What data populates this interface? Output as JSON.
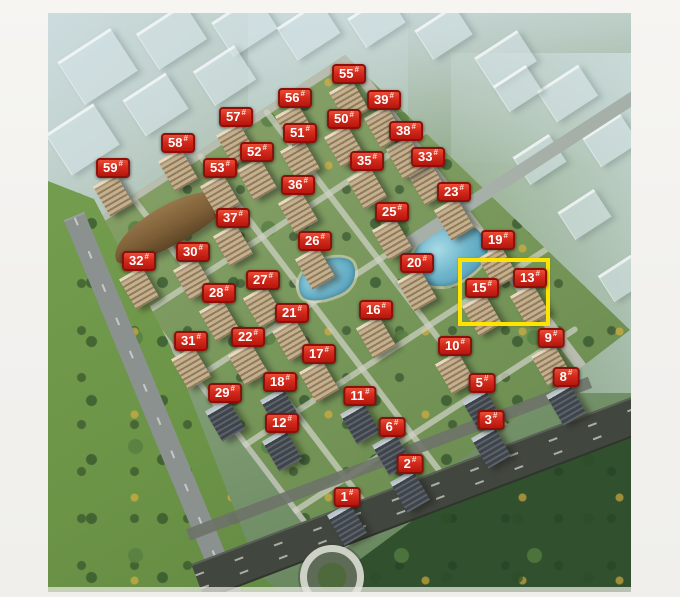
{
  "badge_suffix": "#",
  "buildings": [
    {
      "label": "1",
      "x": 347,
      "y": 497
    },
    {
      "label": "2",
      "x": 410,
      "y": 464
    },
    {
      "label": "3",
      "x": 491,
      "y": 420
    },
    {
      "label": "5",
      "x": 482,
      "y": 383
    },
    {
      "label": "6",
      "x": 392,
      "y": 427
    },
    {
      "label": "8",
      "x": 566,
      "y": 377
    },
    {
      "label": "9",
      "x": 551,
      "y": 338
    },
    {
      "label": "10",
      "x": 455,
      "y": 346
    },
    {
      "label": "11",
      "x": 360,
      "y": 396
    },
    {
      "label": "12",
      "x": 282,
      "y": 423
    },
    {
      "label": "13",
      "x": 530,
      "y": 278
    },
    {
      "label": "15",
      "x": 482,
      "y": 288
    },
    {
      "label": "16",
      "x": 376,
      "y": 310
    },
    {
      "label": "17",
      "x": 319,
      "y": 354
    },
    {
      "label": "18",
      "x": 280,
      "y": 382
    },
    {
      "label": "19",
      "x": 498,
      "y": 240
    },
    {
      "label": "20",
      "x": 417,
      "y": 263
    },
    {
      "label": "21",
      "x": 292,
      "y": 313
    },
    {
      "label": "22",
      "x": 248,
      "y": 337
    },
    {
      "label": "23",
      "x": 454,
      "y": 192
    },
    {
      "label": "25",
      "x": 392,
      "y": 212
    },
    {
      "label": "26",
      "x": 315,
      "y": 241
    },
    {
      "label": "27",
      "x": 263,
      "y": 280
    },
    {
      "label": "28",
      "x": 219,
      "y": 293
    },
    {
      "label": "29",
      "x": 225,
      "y": 393
    },
    {
      "label": "30",
      "x": 193,
      "y": 252
    },
    {
      "label": "31",
      "x": 191,
      "y": 341
    },
    {
      "label": "32",
      "x": 139,
      "y": 261
    },
    {
      "label": "33",
      "x": 428,
      "y": 157
    },
    {
      "label": "35",
      "x": 367,
      "y": 161
    },
    {
      "label": "36",
      "x": 298,
      "y": 185
    },
    {
      "label": "37",
      "x": 233,
      "y": 218
    },
    {
      "label": "38",
      "x": 406,
      "y": 131
    },
    {
      "label": "39",
      "x": 384,
      "y": 100
    },
    {
      "label": "50",
      "x": 344,
      "y": 119
    },
    {
      "label": "51",
      "x": 300,
      "y": 133
    },
    {
      "label": "52",
      "x": 257,
      "y": 152
    },
    {
      "label": "53",
      "x": 220,
      "y": 168
    },
    {
      "label": "55",
      "x": 349,
      "y": 74
    },
    {
      "label": "56",
      "x": 295,
      "y": 98
    },
    {
      "label": "57",
      "x": 236,
      "y": 117
    },
    {
      "label": "58",
      "x": 178,
      "y": 143
    },
    {
      "label": "59",
      "x": 113,
      "y": 168
    }
  ],
  "highlight": {
    "x": 458,
    "y": 258,
    "width": 92,
    "height": 68,
    "color": "#ffe400",
    "contains": [
      "15#",
      "13#"
    ]
  },
  "colors": {
    "badge_fill": "#d42a1c",
    "badge_border": "#8c0f09",
    "badge_text": "#ffffff",
    "highlight": "#ffe400",
    "margin_background": "#f4f3f0",
    "lake": "#5fa8c2",
    "greenery": "#6e8c63"
  }
}
